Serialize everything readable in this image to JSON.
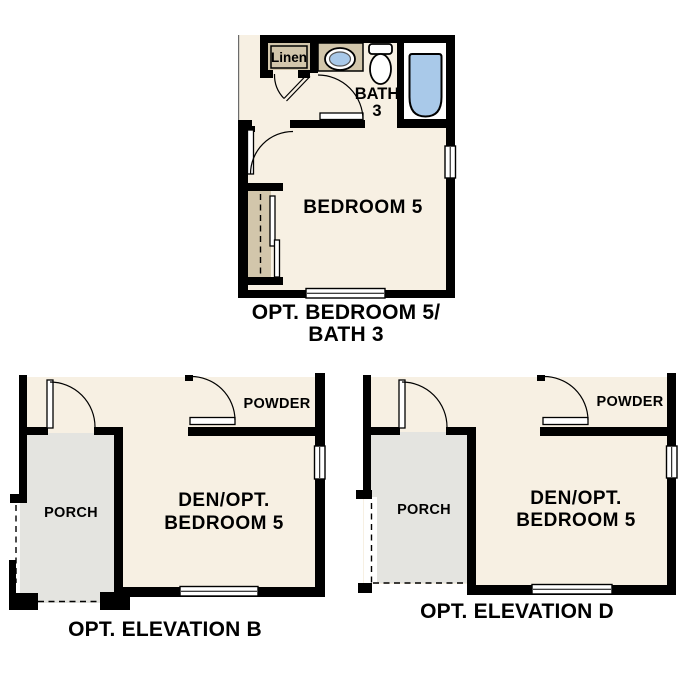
{
  "colors": {
    "floor": "#f7f0e3",
    "cabinet": "#d2c6ab",
    "porch": "#e4e4e0",
    "fixture_blue": "#a9c9e9",
    "wall": "#000000",
    "background": "#ffffff",
    "cut_line": "#6b6b6b"
  },
  "plan_bedroom5_bath3": {
    "caption_line1": "OPT. BEDROOM 5/",
    "caption_line2": "BATH 3",
    "room_label": "BEDROOM 5",
    "bath_label_line1": "BATH",
    "bath_label_line2": "3",
    "linen_label": "Linen"
  },
  "plan_elevation_b": {
    "caption": "OPT. ELEVATION B",
    "den_label_line1": "DEN/OPT.",
    "den_label_line2": "BEDROOM 5",
    "porch_label": "PORCH",
    "powder_label": "POWDER"
  },
  "plan_elevation_d": {
    "caption": "OPT. ELEVATION D",
    "den_label_line1": "DEN/OPT.",
    "den_label_line2": "BEDROOM 5",
    "porch_label": "PORCH",
    "powder_label": "POWDER"
  }
}
